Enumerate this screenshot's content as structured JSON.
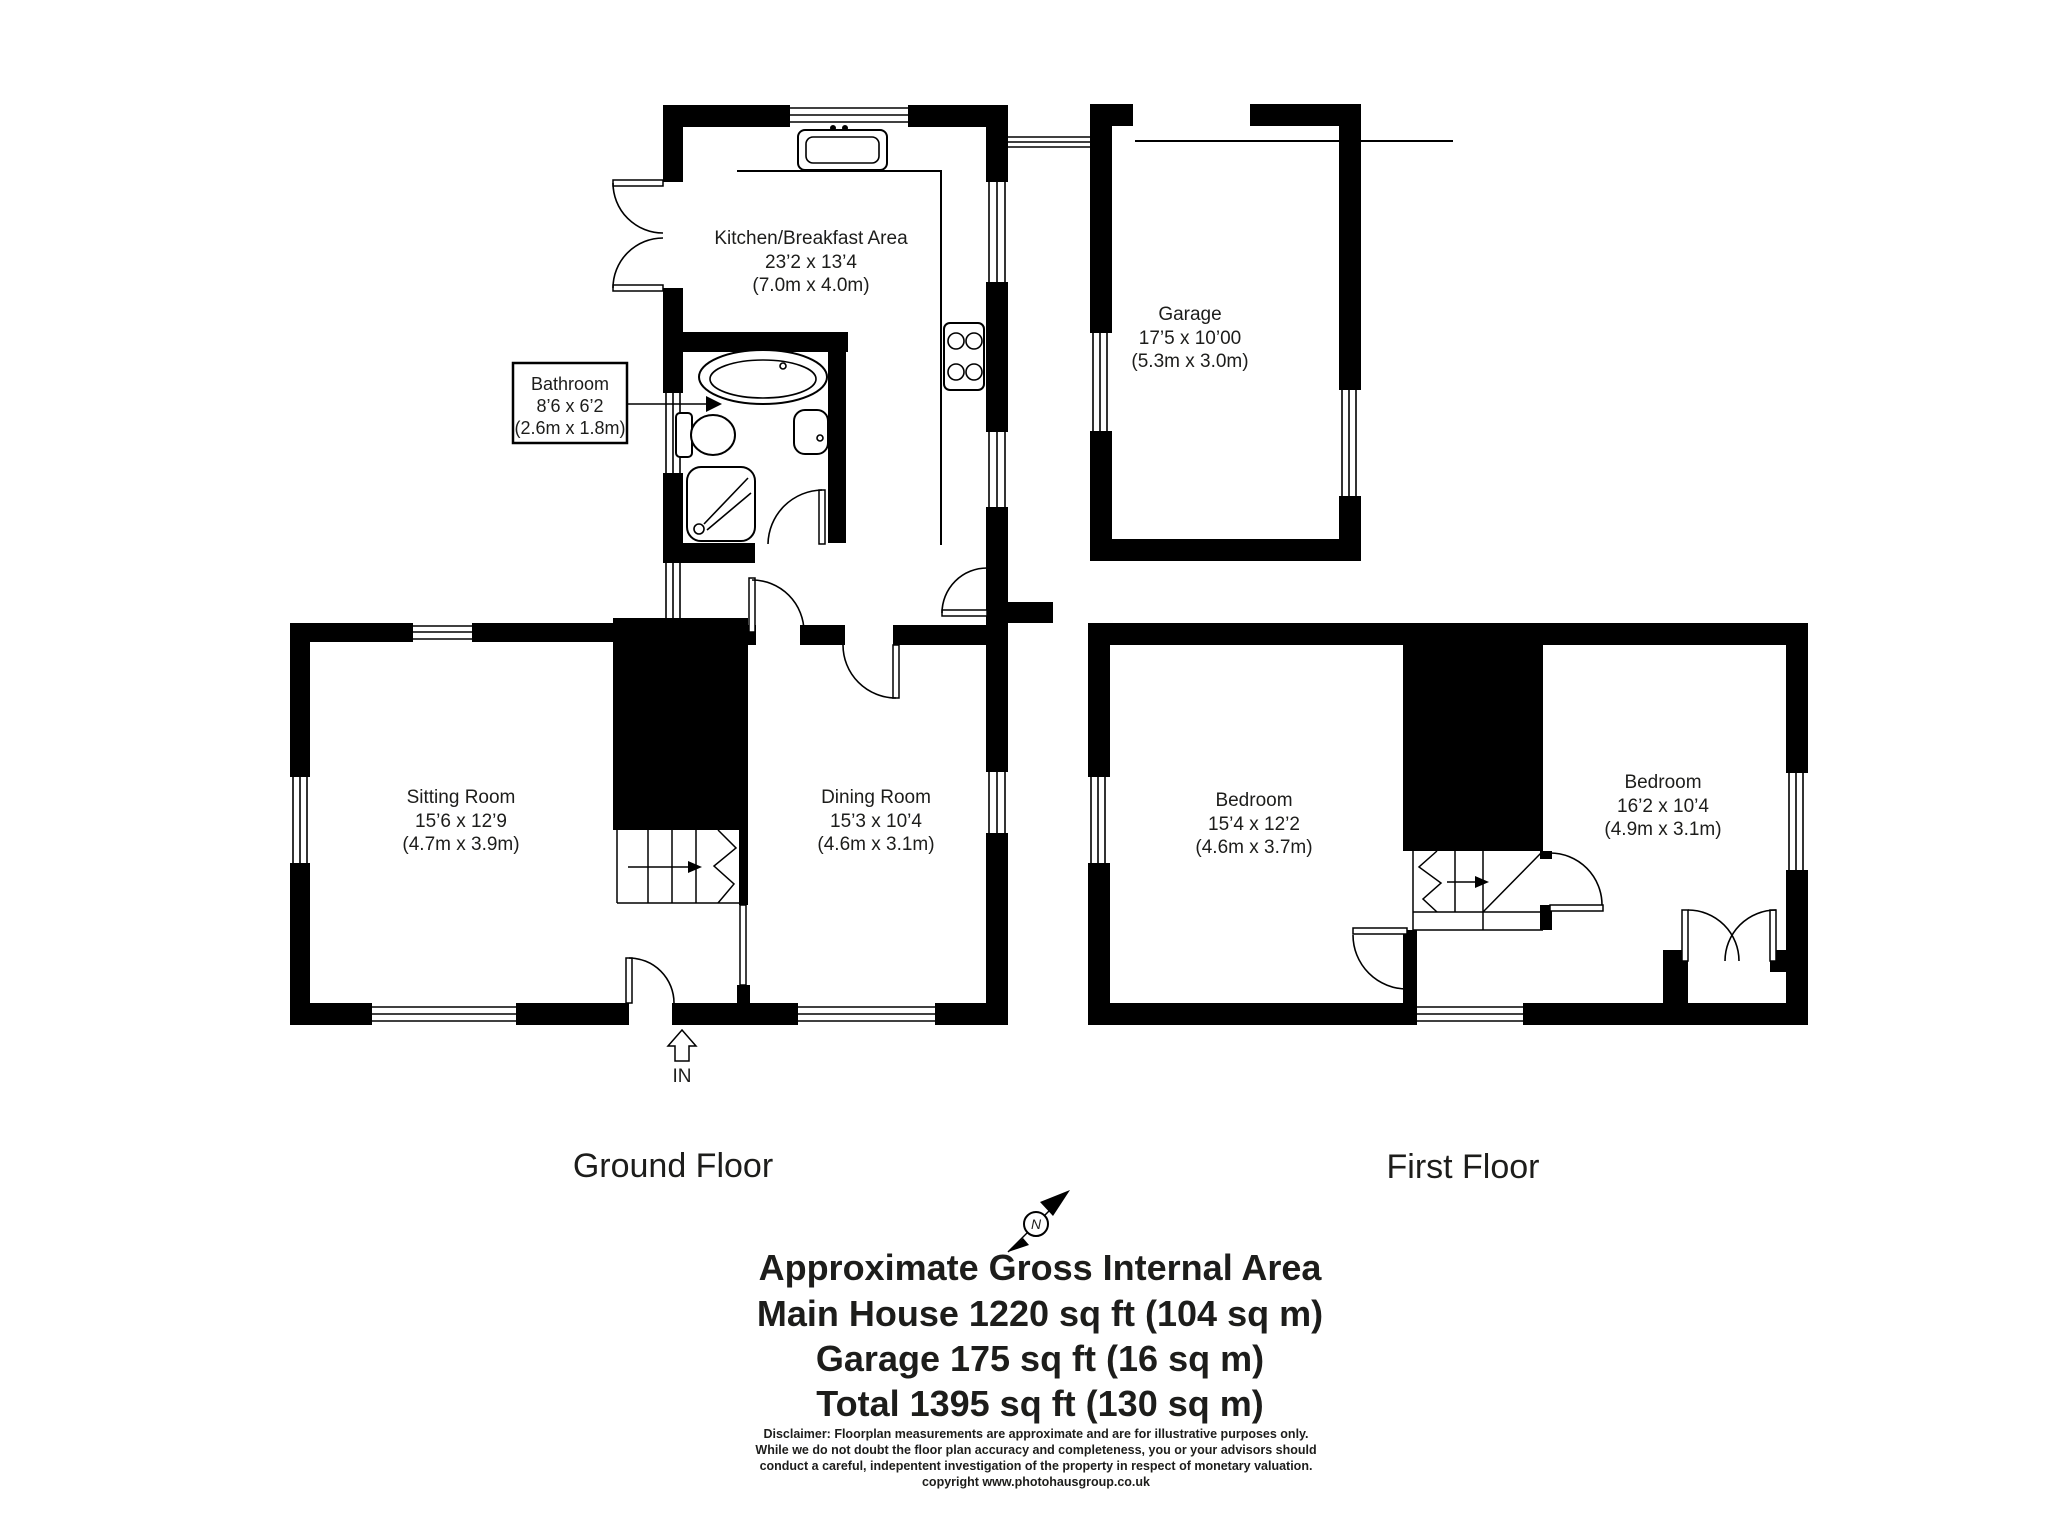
{
  "ground_floor": {
    "title": "Ground Floor",
    "entrance_label": "IN",
    "rooms": {
      "kitchen": {
        "name": "Kitchen/Breakfast Area",
        "size_imperial": "23’2 x 13’4",
        "size_metric": "(7.0m x 4.0m)"
      },
      "bathroom": {
        "name": "Bathroom",
        "size_imperial": "8’6 x 6’2",
        "size_metric": "(2.6m x 1.8m)"
      },
      "sitting_room": {
        "name": "Sitting Room",
        "size_imperial": "15’6 x 12’9",
        "size_metric": "(4.7m x 3.9m)"
      },
      "dining_room": {
        "name": "Dining Room",
        "size_imperial": "15’3 x 10’4",
        "size_metric": "(4.6m x 3.1m)"
      }
    }
  },
  "garage": {
    "name": "Garage",
    "size_imperial": "17’5 x 10’00",
    "size_metric": "(5.3m x 3.0m)"
  },
  "first_floor": {
    "title": "First Floor",
    "rooms": {
      "bedroom_left": {
        "name": "Bedroom",
        "size_imperial": "15’4 x 12’2",
        "size_metric": "(4.6m x 3.7m)"
      },
      "bedroom_right": {
        "name": "Bedroom",
        "size_imperial": "16’2 x 10’4",
        "size_metric": "(4.9m x 3.1m)"
      }
    }
  },
  "compass": {
    "north_label": "N"
  },
  "summary": {
    "heading": "Approximate Gross Internal Area",
    "lines": [
      "Main House 1220 sq ft (104 sq m)",
      "Garage 175 sq ft (16 sq m)",
      "Total 1395 sq ft (130 sq m)"
    ]
  },
  "disclaimer": {
    "lines": [
      "Disclaimer: Floorplan measurements are approximate and are for illustrative purposes only.",
      "While we do not doubt the floor plan accuracy and completeness, you or your advisors should",
      "conduct a careful, indepentent investigation of the property in respect of monetary valuation.",
      "copyright www.photohausgroup.co.uk"
    ]
  },
  "colors": {
    "wall": "#000000",
    "background": "#ffffff",
    "text": "#1d1d1b"
  }
}
